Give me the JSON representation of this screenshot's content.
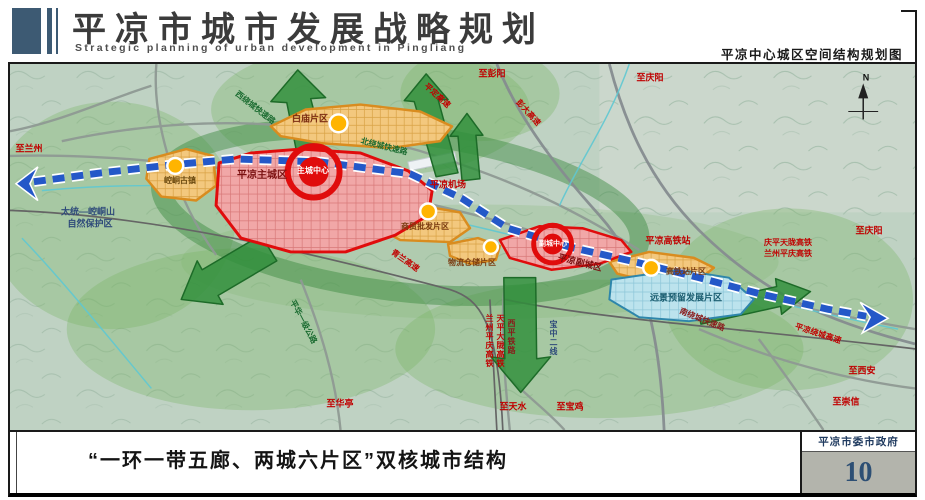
{
  "header": {
    "title_cn": "平凉市城市发展战略规划",
    "title_en": "Strategic planning of urban development in Pingliang",
    "subtitle_right": "平凉中心城区空间结构规划图"
  },
  "footer": {
    "caption": "“一环一带五廊、两城六片区”双核城市结构",
    "agency": "平凉市委市政府",
    "page_number": "10"
  },
  "colors": {
    "header_blue": "#3d5a73",
    "page_number_blue": "#2d4f74",
    "zone_red": "#e00c0c",
    "zone_orange": "#d98c1f",
    "zone_blue": "#2e86ab",
    "corridor_green": "#2f8f3a",
    "transit_blue": "#2458c8",
    "label_red": "#c00000"
  },
  "map": {
    "labels": [
      {
        "id": "compass-n",
        "text": "N",
        "x": 866,
        "y": 78,
        "color": "#111111",
        "size": 9
      },
      {
        "id": "to-lanzhou",
        "text": "至兰州",
        "x": 29,
        "y": 149,
        "color": "#c00000",
        "size": 9
      },
      {
        "id": "nature-reserve-1",
        "text": "太统—崆峒山",
        "x": 88,
        "y": 212,
        "color": "#2e4a7a",
        "size": 9
      },
      {
        "id": "nature-reserve-2",
        "text": "自然保护区",
        "x": 90,
        "y": 224,
        "color": "#2e4a7a",
        "size": 9
      },
      {
        "id": "west-ring-road",
        "text": "西绕城快速路",
        "x": 255,
        "y": 108,
        "color": "#1a6b30",
        "size": 8,
        "rotate": 38
      },
      {
        "id": "baimiao-district",
        "text": "白庙片区",
        "x": 310,
        "y": 119,
        "color": "#7a2a10",
        "size": 9
      },
      {
        "id": "pingding-expressway",
        "text": "平定高速",
        "x": 437,
        "y": 96,
        "color": "#c00000",
        "size": 8,
        "rotate": 42
      },
      {
        "id": "north-ring-road",
        "text": "北绕城快速路",
        "x": 384,
        "y": 147,
        "color": "#1a6b30",
        "size": 8,
        "rotate": 14
      },
      {
        "id": "to-pengyang",
        "text": "至彭阳",
        "x": 492,
        "y": 74,
        "color": "#c00000",
        "size": 9
      },
      {
        "id": "pengda-expressway",
        "text": "彭大高速",
        "x": 528,
        "y": 113,
        "color": "#c00000",
        "size": 8,
        "rotate": 48
      },
      {
        "id": "to-qingyang-top",
        "text": "至庆阳",
        "x": 650,
        "y": 78,
        "color": "#c00000",
        "size": 9
      },
      {
        "id": "pingliang-airport",
        "text": "平凉机场",
        "x": 448,
        "y": 185,
        "color": "#c00000",
        "size": 9
      },
      {
        "id": "main-city",
        "text": "平凉主城区",
        "x": 262,
        "y": 176,
        "color": "#7a1010",
        "size": 10
      },
      {
        "id": "main-center",
        "text": "主城中心",
        "x": 313,
        "y": 171,
        "color": "#ffffff",
        "size": 8
      },
      {
        "id": "kongtong-town",
        "text": "崆峒古镇",
        "x": 180,
        "y": 181,
        "color": "#6b4a10",
        "size": 8
      },
      {
        "id": "trade-district",
        "text": "商贸批发片区",
        "x": 425,
        "y": 227,
        "color": "#7a3b10",
        "size": 8
      },
      {
        "id": "qinglan-expressway",
        "text": "青兰高速",
        "x": 405,
        "y": 261,
        "color": "#c00000",
        "size": 8,
        "rotate": 35
      },
      {
        "id": "logistics-district",
        "text": "物流仓储片区",
        "x": 472,
        "y": 263,
        "color": "#7a3b10",
        "size": 8
      },
      {
        "id": "sub-center",
        "text": "副城中心",
        "x": 553,
        "y": 244,
        "color": "#ffffff",
        "size": 7
      },
      {
        "id": "sub-city",
        "text": "平凉副城区",
        "x": 580,
        "y": 263,
        "color": "#7a1010",
        "size": 9,
        "rotate": 14
      },
      {
        "id": "hsr-station",
        "text": "平凉高铁站",
        "x": 668,
        "y": 241,
        "color": "#c00000",
        "size": 9
      },
      {
        "id": "hsr-line-1",
        "text": "庆平天陇高铁",
        "x": 788,
        "y": 243,
        "color": "#c00000",
        "size": 8
      },
      {
        "id": "hsr-line-2",
        "text": "兰州平庆高铁",
        "x": 788,
        "y": 254,
        "color": "#c00000",
        "size": 8
      },
      {
        "id": "to-qingyang-right",
        "text": "至庆阳",
        "x": 869,
        "y": 231,
        "color": "#c00000",
        "size": 9
      },
      {
        "id": "hsr-district",
        "text": "高铁站片区",
        "x": 686,
        "y": 272,
        "color": "#7a3b10",
        "size": 8
      },
      {
        "id": "reserved-district",
        "text": "远景预留发展片区",
        "x": 686,
        "y": 298,
        "color": "#1a5d70",
        "size": 9
      },
      {
        "id": "south-ring-road",
        "text": "南绕城快速路",
        "x": 702,
        "y": 320,
        "color": "#8a1a1a",
        "size": 8,
        "rotate": 22
      },
      {
        "id": "pinghua-road",
        "text": "平华一级公路",
        "x": 303,
        "y": 322,
        "color": "#1a6b30",
        "size": 8,
        "rotate": 62
      },
      {
        "id": "to-huating",
        "text": "至华亭",
        "x": 340,
        "y": 404,
        "color": "#c00000",
        "size": 9
      },
      {
        "id": "lanzhou-pingqing-hsr",
        "text": "兰州平庆高铁",
        "x": 489,
        "y": 341,
        "color": "#c00000",
        "size": 8,
        "vertical": true
      },
      {
        "id": "tianping-dalong-hsr",
        "text": "天平大陇高铁",
        "x": 500,
        "y": 341,
        "color": "#c00000",
        "size": 8,
        "vertical": true
      },
      {
        "id": "xiping-railway",
        "text": "西平铁路",
        "x": 511,
        "y": 337,
        "color": "#8a1a1a",
        "size": 8,
        "vertical": true
      },
      {
        "id": "baozhong-line",
        "text": "宝中二线",
        "x": 553,
        "y": 338,
        "color": "#2e4a7a",
        "size": 8,
        "vertical": true
      },
      {
        "id": "to-tianshui",
        "text": "至天水",
        "x": 513,
        "y": 407,
        "color": "#c00000",
        "size": 9
      },
      {
        "id": "to-baoji",
        "text": "至宝鸡",
        "x": 570,
        "y": 407,
        "color": "#c00000",
        "size": 9
      },
      {
        "id": "ring-expressway",
        "text": "平凉绕城高速",
        "x": 818,
        "y": 334,
        "color": "#c00000",
        "size": 8,
        "rotate": 18
      },
      {
        "id": "to-xian",
        "text": "至西安",
        "x": 862,
        "y": 371,
        "color": "#c00000",
        "size": 9
      },
      {
        "id": "to-chongxin",
        "text": "至崇信",
        "x": 846,
        "y": 402,
        "color": "#c00000",
        "size": 9
      }
    ]
  }
}
